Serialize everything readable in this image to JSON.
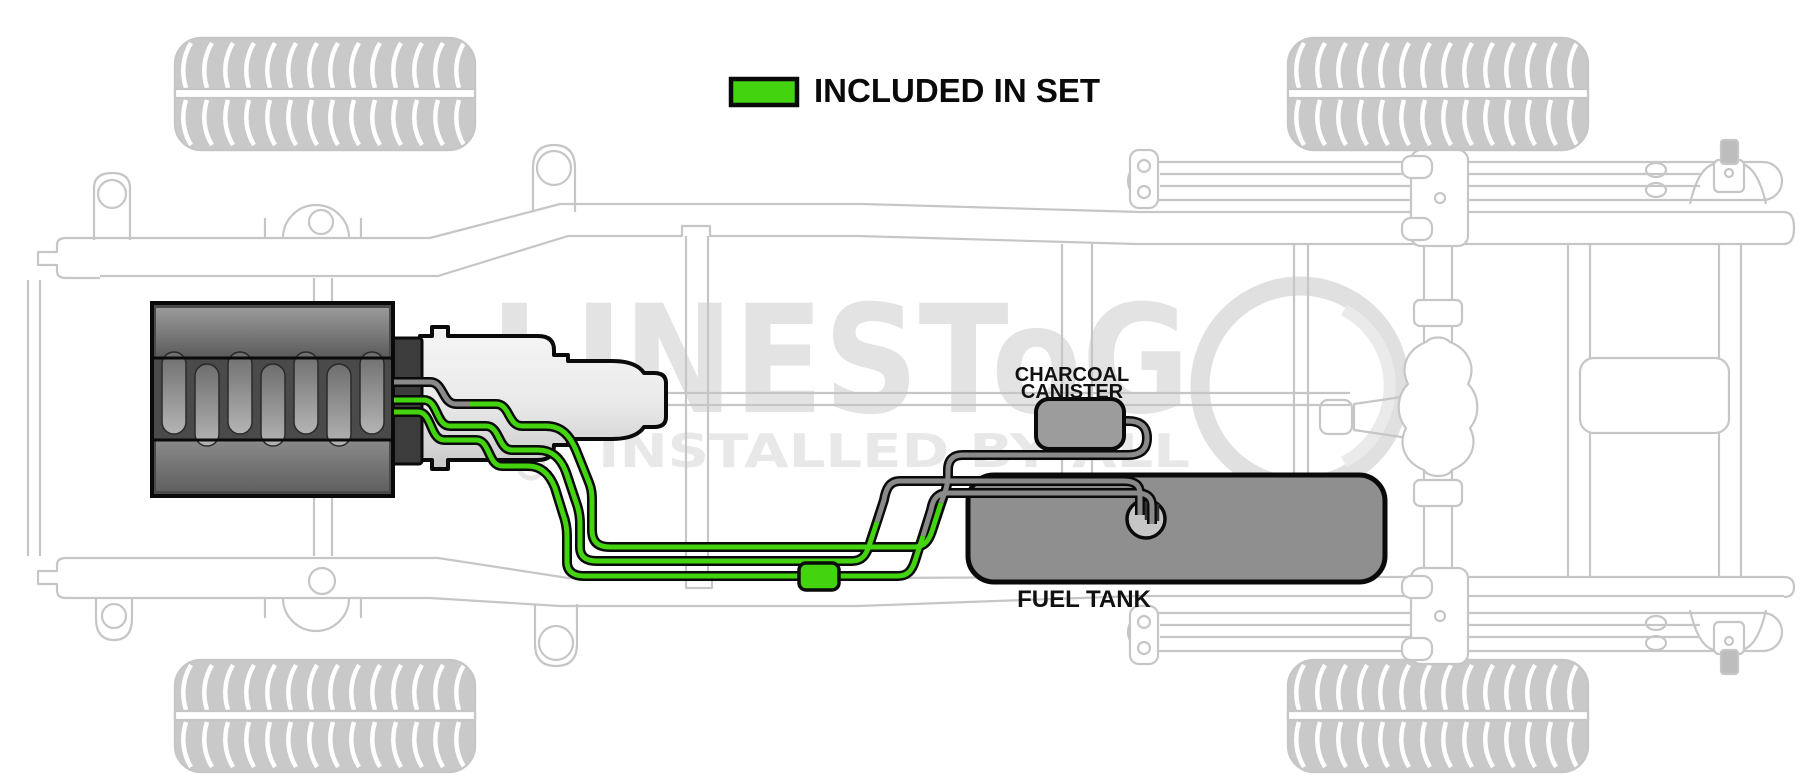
{
  "page": {
    "width": 1800,
    "height": 784,
    "background": "#ffffff"
  },
  "legend": {
    "label": "INCLUDED IN SET",
    "swatch_color": "#43d40f"
  },
  "labels": {
    "charcoal_canister": [
      "CHARCOAL",
      "CANISTER"
    ],
    "fuel_tank": "FUEL TANK"
  },
  "watermark": {
    "brand": "LINESToG",
    "tagline": "INSTALLED BY ALL"
  },
  "colors": {
    "included_line": "#43d40f",
    "other_line": "#8a8a8a",
    "line_casing": "#0a0a0a",
    "chassis": "#c6c6c6",
    "fuel_tank_fill": "#8f8f8f",
    "canister_fill": "#9c9c9c",
    "pump_fill": "#c6c6c6"
  },
  "components": [
    "front wheel left",
    "front wheel right",
    "rear wheel left",
    "rear wheel right",
    "frame rails",
    "crossmembers",
    "engine",
    "transmission",
    "driveshaft",
    "rear axle",
    "differential",
    "leaf springs",
    "charcoal canister",
    "fuel tank",
    "fuel pump module",
    "inline line fitting",
    "fuel lines included in set",
    "existing fuel lines"
  ]
}
